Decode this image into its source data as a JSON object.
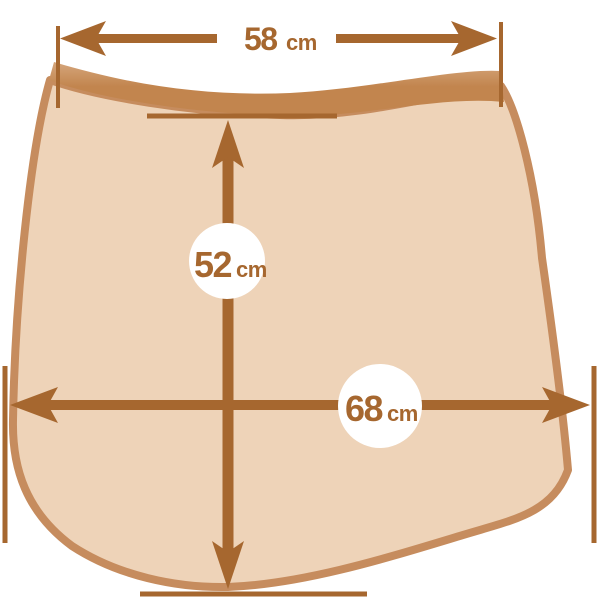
{
  "diagram": {
    "kind": "garment-dimension-diagram",
    "measurements": {
      "top_width": {
        "value": "58",
        "unit": "cm"
      },
      "center_height": {
        "value": "52",
        "unit": "cm"
      },
      "bottom_width": {
        "value": "68",
        "unit": "cm"
      }
    },
    "colors": {
      "background": "#ffffff",
      "garment_body_fill": "#eed3b8",
      "waistband_fill": "#c2854e",
      "waistband_highlight": "#d5a67c",
      "garment_outline": "#c68c5e",
      "arrow_and_tick": "#a6672f",
      "label_text": "#a6672f",
      "label_circle_fill": "#ffffff"
    }
  }
}
